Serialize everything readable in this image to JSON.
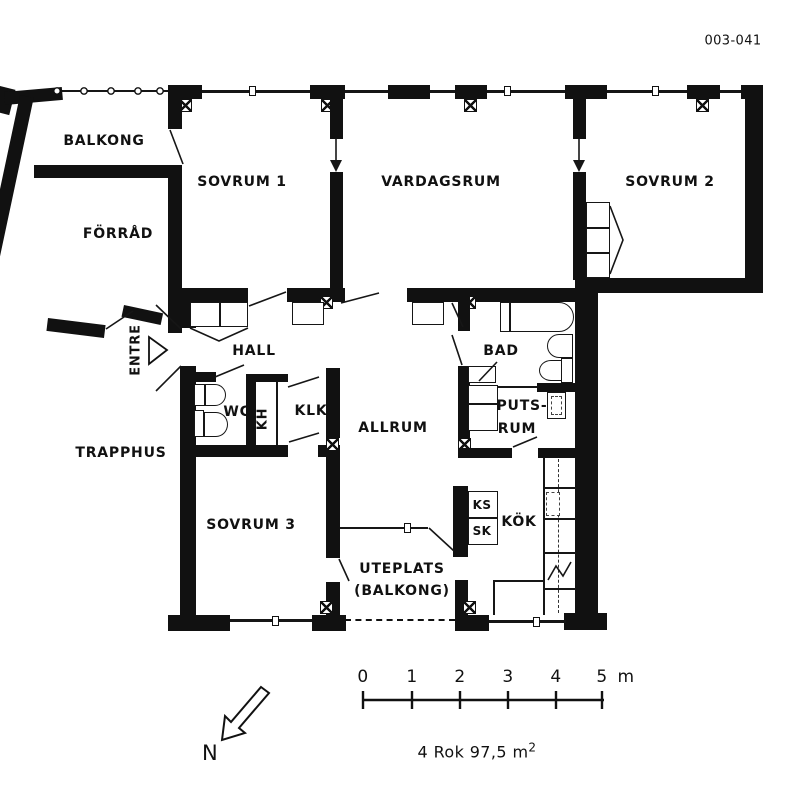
{
  "plan_number": "003-041",
  "rooms": {
    "balkong": "BALKONG",
    "forrad": "FÖRRÅD",
    "sovrum1": "SOVRUM 1",
    "vardagsrum": "VARDAGSRUM",
    "sovrum2": "SOVRUM 2",
    "entre": "ENTRE",
    "hall": "HALL",
    "trapphus": "TRAPPHUS",
    "wc": "WC",
    "kh": "KH",
    "klk": "KLK",
    "bad": "BAD",
    "putsrum_line1": "PUTS-",
    "putsrum_line2": "RUM",
    "allrum": "ALLRUM",
    "sovrum3": "SOVRUM 3",
    "ks": "KS",
    "sk": "SK",
    "kok": "KÖK",
    "uteplats_line1": "UTEPLATS",
    "uteplats_line2": "(BALKONG)"
  },
  "scale_bar": {
    "ticks": [
      "0",
      "1",
      "2",
      "3",
      "4",
      "5"
    ],
    "unit": "m"
  },
  "compass": {
    "north_label": "N"
  },
  "summary": {
    "text": "4 Rok 97,5 m",
    "superscript": "2"
  },
  "colors": {
    "wall": "#111111",
    "background": "#ffffff"
  }
}
